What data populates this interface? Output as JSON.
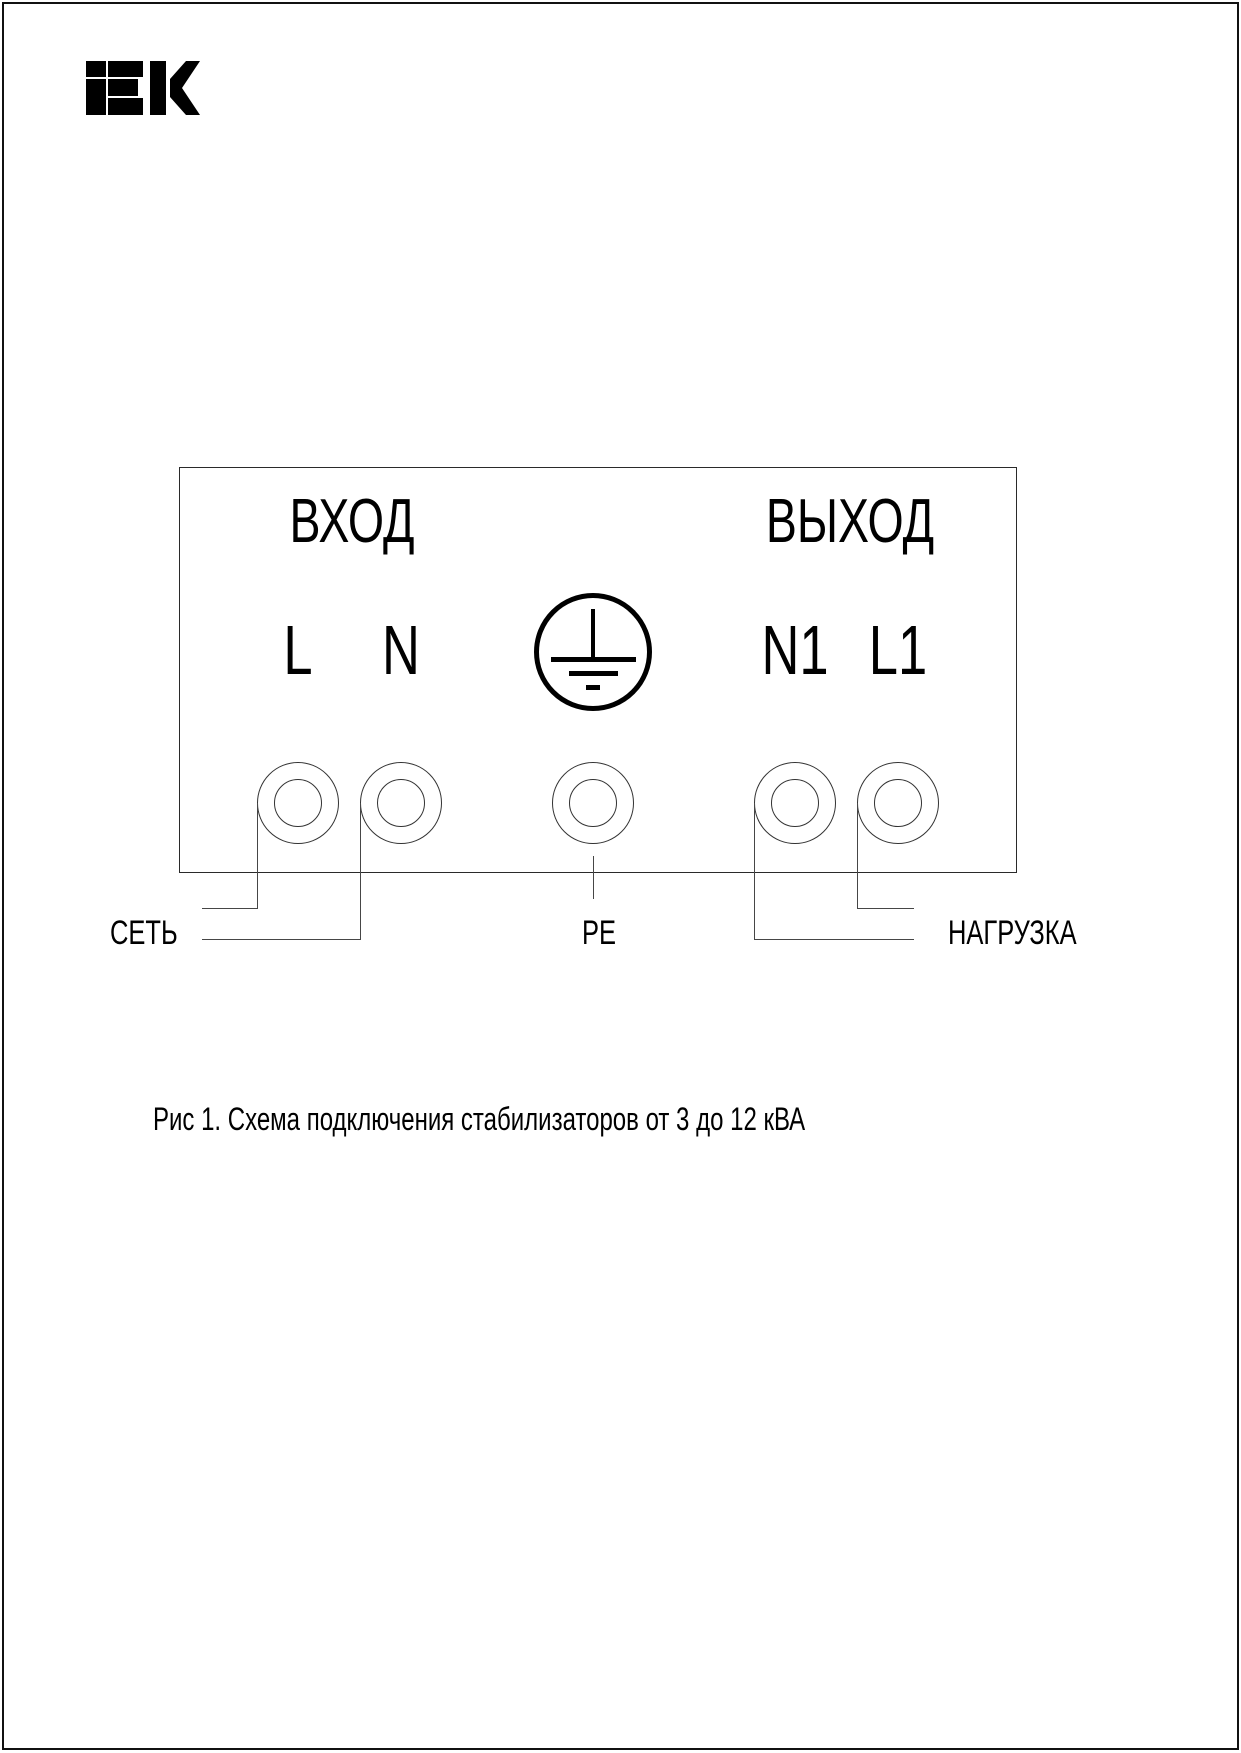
{
  "logo": {
    "name": "IEK"
  },
  "diagram": {
    "input_section_label": "ВХОД",
    "output_section_label": "ВЫХОД",
    "terminals": {
      "l": "L",
      "n": "N",
      "n1": "N1",
      "l1": "L1"
    },
    "labels": {
      "mains": "СЕТЬ",
      "pe": "PE",
      "load": "НАГРУЗКА"
    }
  },
  "caption": {
    "text": "Рис 1. Схема подключения стабилизаторов от 3 до 12 кВА"
  },
  "colors": {
    "line": "#464646",
    "text": "#000000",
    "background": "#ffffff"
  }
}
